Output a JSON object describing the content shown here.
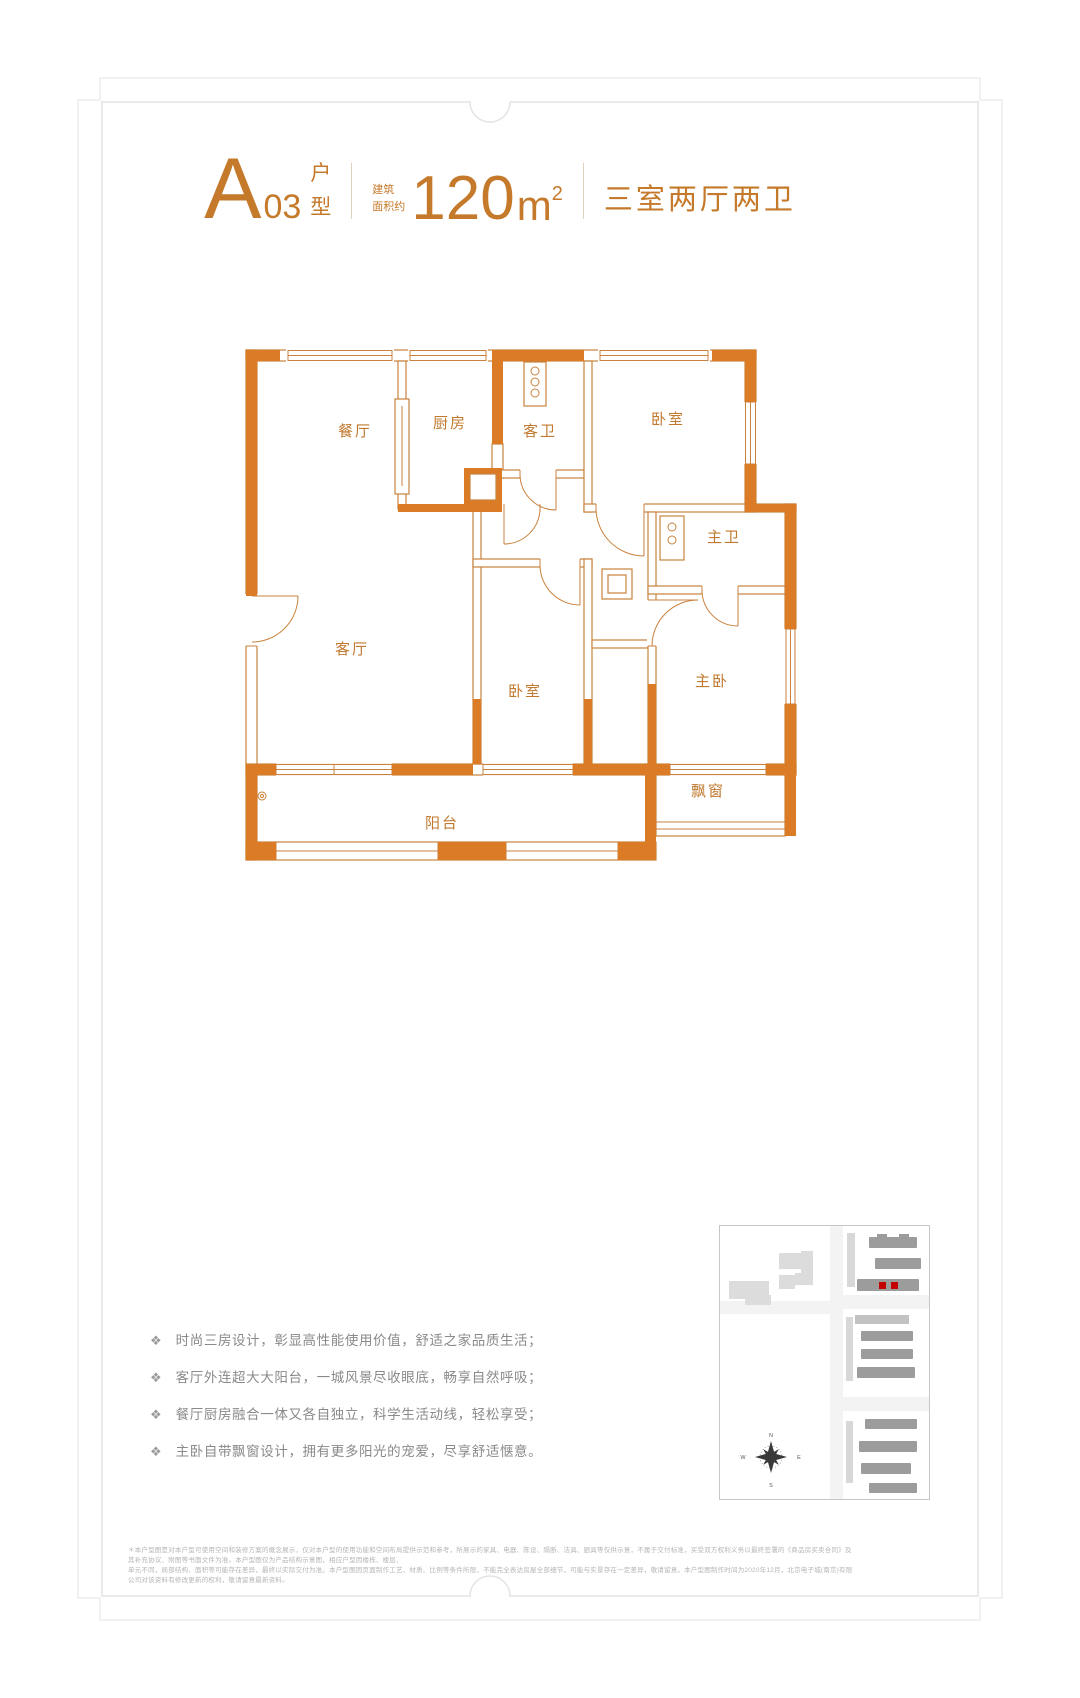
{
  "colors": {
    "accent_orange": "#c5792a",
    "wall_orange": "#db7b25",
    "plan_line": "#c9823e",
    "highlight_red": "#c40000",
    "feature_text_gray": "#8a8a8a"
  },
  "header": {
    "letter": "A",
    "number": "03",
    "suffix_top": "户",
    "suffix_bottom": "型",
    "area_label_top": "建筑",
    "area_label_bottom": "面积约",
    "area_value": "120",
    "area_unit": "m",
    "area_exp": "2",
    "rooms_text": "三室两厅两卫"
  },
  "floorplan": {
    "rooms": {
      "dining": "餐厅",
      "kitchen": "厨房",
      "guest_bath": "客卫",
      "bedroom_top": "卧室",
      "master_bath": "主卫",
      "living": "客厅",
      "bedroom_second": "卧室",
      "master": "主卧",
      "bay": "飘窗",
      "balcony": "阳台"
    }
  },
  "features": {
    "icon": "❖",
    "items": [
      "时尚三房设计，彰显高性能使用价值，舒适之家品质生活；",
      "客厅外连超大大阳台，一城风景尽收眼底，畅享自然呼吸；",
      "餐厅厨房融合一体又各自独立，科学生活动线，轻松享受；",
      "主卧自带飘窗设计，拥有更多阳光的宠爱，尽享舒适惬意。"
    ]
  },
  "sitemap": {
    "compass": {
      "n": "N",
      "e": "E",
      "s": "S",
      "w": "W"
    }
  },
  "disclaimer": {
    "line1": "＊本户型图是对本户型可使用空间和装修方案的概念展示，仅对本户型的使用功能和空间布局提供示范和参考，所展示的家具、电器、陈设、隔断、洁具、厨具等仅供示意，不属于交付标准，买受双方权利义务以最终签署的《商品房买卖合同》及其补充协议、附图等书面文件为准。本户型图仅为产品结构示意图，相应户型因楼栋、楼层、",
    "line2": "单元不同，局部结构、面积等可能存在差异，最终以实际交付为准。本户型图因页面制作工艺、材质、比例等条件所限，不能完全表达房屋全部细节，可能与实景存在一定差异，敬请留意。本户型图制作时间为2020年12月，北京电子城(南京)有限公司对该资料有修改更新的权利，敬请留意最新资料。"
  }
}
